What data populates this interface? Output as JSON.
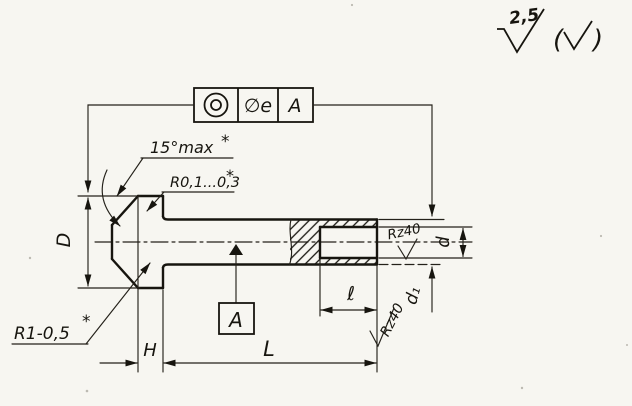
{
  "surface_finish": {
    "value": "2,5",
    "paren_open": "(",
    "paren_close": ")"
  },
  "fcf": {
    "tolerance": "∅e",
    "datum": "A"
  },
  "labels": {
    "angle": "15°max",
    "angle_star": "*",
    "fillet_top": "R0,1...0,3",
    "fillet_top_star": "*",
    "fillet_head": "R1-0,5",
    "fillet_head_star": "*"
  },
  "dimensions": {
    "head_diameter": "D",
    "head_height": "H",
    "length": "L",
    "hole_depth": "ℓ",
    "hole_diameter": "d",
    "stem_diameter": "d₁"
  },
  "datum": {
    "label": "A"
  },
  "roughness": {
    "hole": "Rz40",
    "face": "Rz40"
  }
}
